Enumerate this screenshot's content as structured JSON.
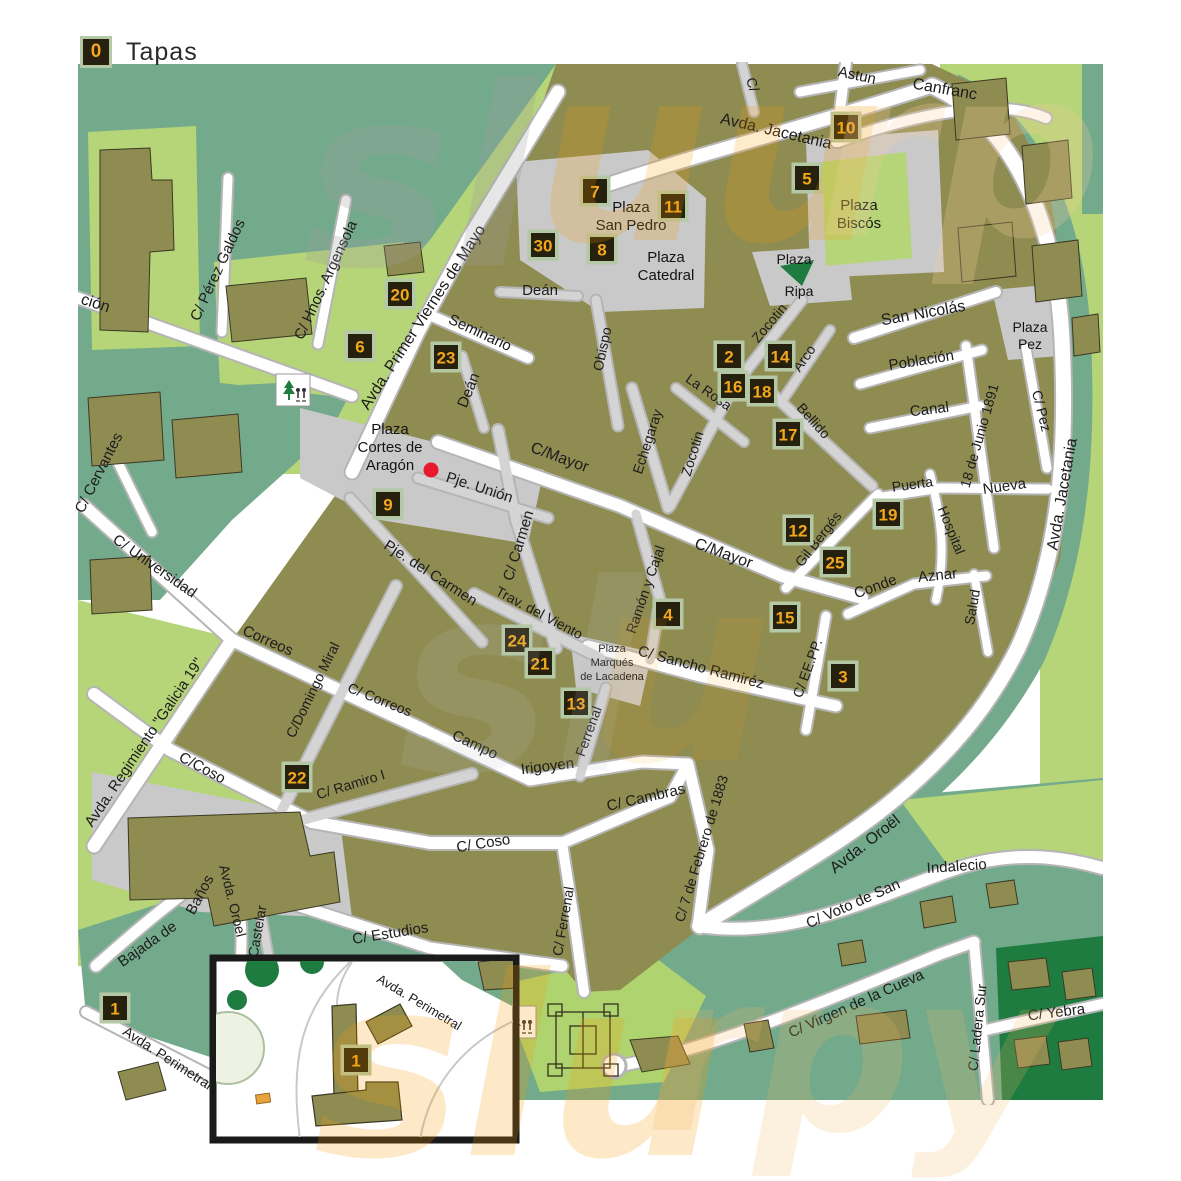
{
  "legend": {
    "marker_number": "0",
    "label": "Tapas"
  },
  "colors": {
    "block_olive": "#8f8c52",
    "green_light": "#b5d578",
    "green_bright": "#aed36f",
    "green_sage": "#74aa8c",
    "green_dark": "#1f7c41",
    "road_white": "#ffffff",
    "road_gray": "#d4d4d4",
    "road_casing": "#b5b5b5",
    "plaza_gray": "#c9c9c9",
    "marker_bg": "#26200f",
    "marker_border": "#b4c8a6",
    "marker_number": "#f3a71b",
    "label_text": "#1c1c1c",
    "watermark_orange": "#f59b00",
    "red_dot": "#e8192c",
    "inset_border": "#1a1a1a"
  },
  "markers": [
    {
      "n": "10",
      "x": 846,
      "y": 127
    },
    {
      "n": "5",
      "x": 807,
      "y": 178
    },
    {
      "n": "7",
      "x": 595,
      "y": 191
    },
    {
      "n": "11",
      "x": 673,
      "y": 206
    },
    {
      "n": "30",
      "x": 543,
      "y": 245
    },
    {
      "n": "8",
      "x": 602,
      "y": 249
    },
    {
      "n": "20",
      "x": 400,
      "y": 294
    },
    {
      "n": "6",
      "x": 360,
      "y": 346
    },
    {
      "n": "23",
      "x": 446,
      "y": 357
    },
    {
      "n": "2",
      "x": 729,
      "y": 356
    },
    {
      "n": "14",
      "x": 780,
      "y": 356
    },
    {
      "n": "16",
      "x": 733,
      "y": 386
    },
    {
      "n": "18",
      "x": 762,
      "y": 391
    },
    {
      "n": "17",
      "x": 788,
      "y": 434
    },
    {
      "n": "9",
      "x": 388,
      "y": 504
    },
    {
      "n": "19",
      "x": 888,
      "y": 514
    },
    {
      "n": "12",
      "x": 798,
      "y": 530
    },
    {
      "n": "25",
      "x": 835,
      "y": 562
    },
    {
      "n": "4",
      "x": 668,
      "y": 614
    },
    {
      "n": "15",
      "x": 785,
      "y": 617
    },
    {
      "n": "3",
      "x": 843,
      "y": 676
    },
    {
      "n": "24",
      "x": 517,
      "y": 640
    },
    {
      "n": "21",
      "x": 540,
      "y": 663
    },
    {
      "n": "13",
      "x": 576,
      "y": 703
    },
    {
      "n": "22",
      "x": 297,
      "y": 777
    },
    {
      "n": "1",
      "x": 115,
      "y": 1008
    },
    {
      "n": "1",
      "x": 356,
      "y": 1060
    }
  ],
  "street_labels": [
    {
      "t": "ción",
      "x": 94,
      "y": 308,
      "r": 18,
      "s": 16
    },
    {
      "t": "C/ Pérez Galdos",
      "x": 222,
      "y": 272,
      "r": -65,
      "s": 15
    },
    {
      "t": "C/ Hnos. Argensola",
      "x": 330,
      "y": 282,
      "r": -65,
      "s": 15
    },
    {
      "t": "Avda. Primer Viernes de Mayo",
      "x": 427,
      "y": 320,
      "r": -57,
      "s": 16
    },
    {
      "t": "Seminario",
      "x": 478,
      "y": 337,
      "r": 25,
      "s": 15
    },
    {
      "t": "Deán",
      "x": 473,
      "y": 392,
      "r": -68,
      "s": 15
    },
    {
      "t": "Deán",
      "x": 540,
      "y": 295,
      "r": 0,
      "s": 15
    },
    {
      "t": "Avda. Jacetania",
      "x": 775,
      "y": 136,
      "r": 13,
      "s": 16
    },
    {
      "t": "Astun",
      "x": 856,
      "y": 80,
      "r": 12,
      "s": 15
    },
    {
      "t": "Canfranc",
      "x": 944,
      "y": 94,
      "r": 10,
      "s": 16
    },
    {
      "t": "C/",
      "x": 748,
      "y": 86,
      "r": 72,
      "s": 14
    },
    {
      "t": "San Nicolás",
      "x": 924,
      "y": 318,
      "r": -10,
      "s": 16
    },
    {
      "t": "Población",
      "x": 922,
      "y": 365,
      "r": -9,
      "s": 15
    },
    {
      "t": "Canal",
      "x": 930,
      "y": 414,
      "r": -7,
      "s": 15
    },
    {
      "t": "Zocotin",
      "x": 773,
      "y": 326,
      "r": -50,
      "s": 14
    },
    {
      "t": "Zocotin",
      "x": 697,
      "y": 455,
      "r": -73,
      "s": 14
    },
    {
      "t": "La Rosa",
      "x": 706,
      "y": 396,
      "r": 35,
      "s": 14
    },
    {
      "t": "Arco",
      "x": 808,
      "y": 361,
      "r": -55,
      "s": 14
    },
    {
      "t": "Bellido",
      "x": 810,
      "y": 424,
      "r": 48,
      "s": 14
    },
    {
      "t": "Obispo",
      "x": 607,
      "y": 350,
      "r": -78,
      "s": 14
    },
    {
      "t": "Echegaray",
      "x": 652,
      "y": 443,
      "r": -72,
      "s": 14
    },
    {
      "t": "C/Mayor",
      "x": 558,
      "y": 462,
      "r": 20,
      "s": 16
    },
    {
      "t": "C/Mayor",
      "x": 722,
      "y": 558,
      "r": 20,
      "s": 16
    },
    {
      "t": "Pje. Unión",
      "x": 478,
      "y": 492,
      "r": 18,
      "s": 15
    },
    {
      "t": "Pje. del Carmen",
      "x": 428,
      "y": 577,
      "r": 33,
      "s": 15
    },
    {
      "t": "C/ Carmen",
      "x": 523,
      "y": 547,
      "r": -73,
      "s": 15
    },
    {
      "t": "Trav. del Viento",
      "x": 537,
      "y": 617,
      "r": 28,
      "s": 14
    },
    {
      "t": "Ramón y Cajal",
      "x": 650,
      "y": 591,
      "r": -71,
      "s": 14
    },
    {
      "t": "Gil Bergés",
      "x": 822,
      "y": 542,
      "r": -52,
      "s": 14
    },
    {
      "t": "Conde",
      "x": 877,
      "y": 591,
      "r": -20,
      "s": 15
    },
    {
      "t": "Aznar",
      "x": 938,
      "y": 580,
      "r": -6,
      "s": 15
    },
    {
      "t": "Salud",
      "x": 977,
      "y": 608,
      "r": -80,
      "s": 14
    },
    {
      "t": "Hospital",
      "x": 947,
      "y": 532,
      "r": 68,
      "s": 14
    },
    {
      "t": "Puerta",
      "x": 913,
      "y": 489,
      "r": -8,
      "s": 14
    },
    {
      "t": "Nueva",
      "x": 1005,
      "y": 491,
      "r": -8,
      "s": 15
    },
    {
      "t": "18 de Junio 1891",
      "x": 984,
      "y": 437,
      "r": -74,
      "s": 14
    },
    {
      "t": "C/ Pez",
      "x": 1037,
      "y": 412,
      "r": 76,
      "s": 14
    },
    {
      "t": "Avda. Jacetania",
      "x": 1067,
      "y": 495,
      "r": -80,
      "s": 16
    },
    {
      "t": "C/ Sancho Ramiréz",
      "x": 700,
      "y": 672,
      "r": 15,
      "s": 15
    },
    {
      "t": "C/ EE.PP.",
      "x": 812,
      "y": 670,
      "r": -70,
      "s": 14
    },
    {
      "t": "Ferrenal",
      "x": 593,
      "y": 733,
      "r": -70,
      "s": 14
    },
    {
      "t": "Irigoyen",
      "x": 548,
      "y": 771,
      "r": -7,
      "s": 15
    },
    {
      "t": "Campo",
      "x": 473,
      "y": 749,
      "r": 25,
      "s": 15
    },
    {
      "t": "C/ Ramiro I",
      "x": 352,
      "y": 789,
      "r": -17,
      "s": 14
    },
    {
      "t": "C/ Correos",
      "x": 378,
      "y": 704,
      "r": 22,
      "s": 14
    },
    {
      "t": "Correos",
      "x": 266,
      "y": 645,
      "r": 24,
      "s": 15
    },
    {
      "t": "C/Domingo Miral",
      "x": 317,
      "y": 692,
      "r": -64,
      "s": 14
    },
    {
      "t": "C/Coso",
      "x": 200,
      "y": 772,
      "r": 28,
      "s": 15
    },
    {
      "t": "C/ Coso",
      "x": 484,
      "y": 848,
      "r": -9,
      "s": 15
    },
    {
      "t": "C/ Cambras",
      "x": 647,
      "y": 802,
      "r": -13,
      "s": 15
    },
    {
      "t": "C/ 7 de Febrero de 1883",
      "x": 706,
      "y": 850,
      "r": -73,
      "s": 14
    },
    {
      "t": "Avda. Oroël",
      "x": 868,
      "y": 848,
      "r": -38,
      "s": 16
    },
    {
      "t": "C/ Universidad",
      "x": 152,
      "y": 570,
      "r": 35,
      "s": 15
    },
    {
      "t": "C/ Cervantes",
      "x": 103,
      "y": 475,
      "r": -63,
      "s": 15
    },
    {
      "t": "Avda. Regimiento \"Galicia 19\"",
      "x": 148,
      "y": 745,
      "r": -56,
      "s": 15
    },
    {
      "t": "Bajada de",
      "x": 150,
      "y": 948,
      "r": -35,
      "s": 15
    },
    {
      "t": "Baños",
      "x": 204,
      "y": 897,
      "r": -62,
      "s": 15
    },
    {
      "t": "Avda. Oroel",
      "x": 228,
      "y": 902,
      "r": 76,
      "s": 14
    },
    {
      "t": "Castelar",
      "x": 262,
      "y": 932,
      "r": -80,
      "s": 14
    },
    {
      "t": "C/ Estudios",
      "x": 391,
      "y": 938,
      "r": -9,
      "s": 15
    },
    {
      "t": "C/ Ferrenal",
      "x": 568,
      "y": 922,
      "r": -80,
      "s": 14
    },
    {
      "t": "Indalecio",
      "x": 957,
      "y": 871,
      "r": -4,
      "s": 15
    },
    {
      "t": "C/ Voto de San",
      "x": 855,
      "y": 908,
      "r": -24,
      "s": 15
    },
    {
      "t": "C/ Virgen de la Cueva",
      "x": 858,
      "y": 1008,
      "r": -24,
      "s": 15
    },
    {
      "t": "C/ Ladera Sur",
      "x": 982,
      "y": 1028,
      "r": -84,
      "s": 14
    },
    {
      "t": "C/ Yebra",
      "x": 1057,
      "y": 1017,
      "r": -7,
      "s": 15
    },
    {
      "t": "Avda. Perimetral",
      "x": 165,
      "y": 1062,
      "r": 33,
      "s": 14
    },
    {
      "t": "Avda. Perimetral",
      "x": 417,
      "y": 1006,
      "r": 31,
      "s": 13
    }
  ],
  "plaza_labels": [
    {
      "lines": [
        "Plaza",
        "San Pedro"
      ],
      "x": 631,
      "y": 212,
      "s": 15
    },
    {
      "lines": [
        "Plaza",
        "Catedral"
      ],
      "x": 666,
      "y": 262,
      "s": 15
    },
    {
      "lines": [
        "Plaza",
        "Biscós"
      ],
      "x": 859,
      "y": 210,
      "s": 15
    },
    {
      "lines": [
        "Plaza"
      ],
      "x": 794,
      "y": 264,
      "s": 14
    },
    {
      "lines": [
        "Ripa"
      ],
      "x": 799,
      "y": 296,
      "s": 14
    },
    {
      "lines": [
        "Plaza",
        "Cortes de",
        "Aragón"
      ],
      "x": 390,
      "y": 434,
      "s": 15
    },
    {
      "lines": [
        "Plaza",
        "Marqués",
        "de Lacadena"
      ],
      "x": 612,
      "y": 652,
      "s": 11
    },
    {
      "lines": [
        "Plaza",
        "Pez"
      ],
      "x": 1030,
      "y": 332,
      "s": 14
    }
  ],
  "map_icons": [
    {
      "name": "park-pictogram-icon",
      "x": 276,
      "y": 374
    },
    {
      "name": "park-pictogram-icon",
      "x": 502,
      "y": 1006
    }
  ],
  "poi": {
    "red_dot": {
      "x": 431,
      "y": 470
    }
  },
  "watermark": [
    {
      "t": "sl",
      "x": 420,
      "y": 265,
      "s": 250,
      "c": "#9c9c9c",
      "o": 0.25
    },
    {
      "t": "uu",
      "x": 710,
      "y": 240,
      "s": 245,
      "c": "#f59b00",
      "o": 0.2
    },
    {
      "t": "rp",
      "x": 960,
      "y": 235,
      "s": 235,
      "c": "#f7cf9a",
      "o": 0.25
    },
    {
      "t": "sl",
      "x": 520,
      "y": 770,
      "s": 260,
      "c": "#bdbdbd",
      "o": 0.14
    },
    {
      "t": "u",
      "x": 680,
      "y": 760,
      "s": 260,
      "c": "#f59b00",
      "o": 0.1
    },
    {
      "t": "slu",
      "x": 520,
      "y": 1155,
      "s": 250,
      "c": "#f59b00",
      "o": 0.22
    },
    {
      "t": "rpy",
      "x": 850,
      "y": 1130,
      "s": 220,
      "c": "#f2b25e",
      "o": 0.2
    }
  ]
}
